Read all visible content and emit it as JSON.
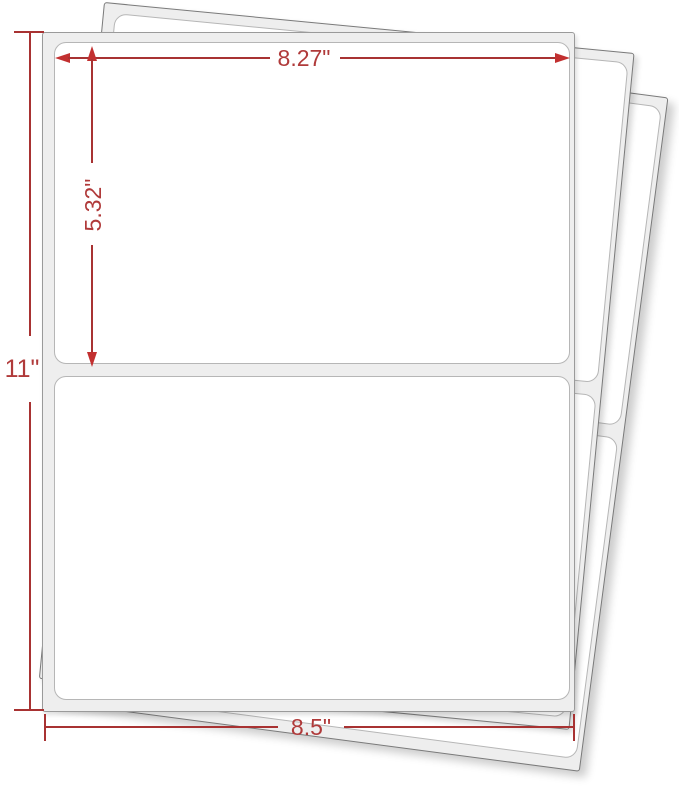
{
  "product_diagram": {
    "kind": "half-sheet shipping label sheets, dimension diagram",
    "sheets_visible": 3,
    "labels_per_sheet": 2
  },
  "annotations": {
    "label_width": "8.27\"",
    "label_height": "5.32\"",
    "page_height": "11\"",
    "page_width": "8.5\""
  },
  "colors": {
    "dim_red": "#a83232",
    "dim_red_text": "#b03a3a",
    "dim_red_bright": "#c23030",
    "margin_gray": "#eeeeee",
    "outline_gray": "#8f8f8f",
    "label_border": "#b6b6b6",
    "page_white": "#ffffff"
  }
}
